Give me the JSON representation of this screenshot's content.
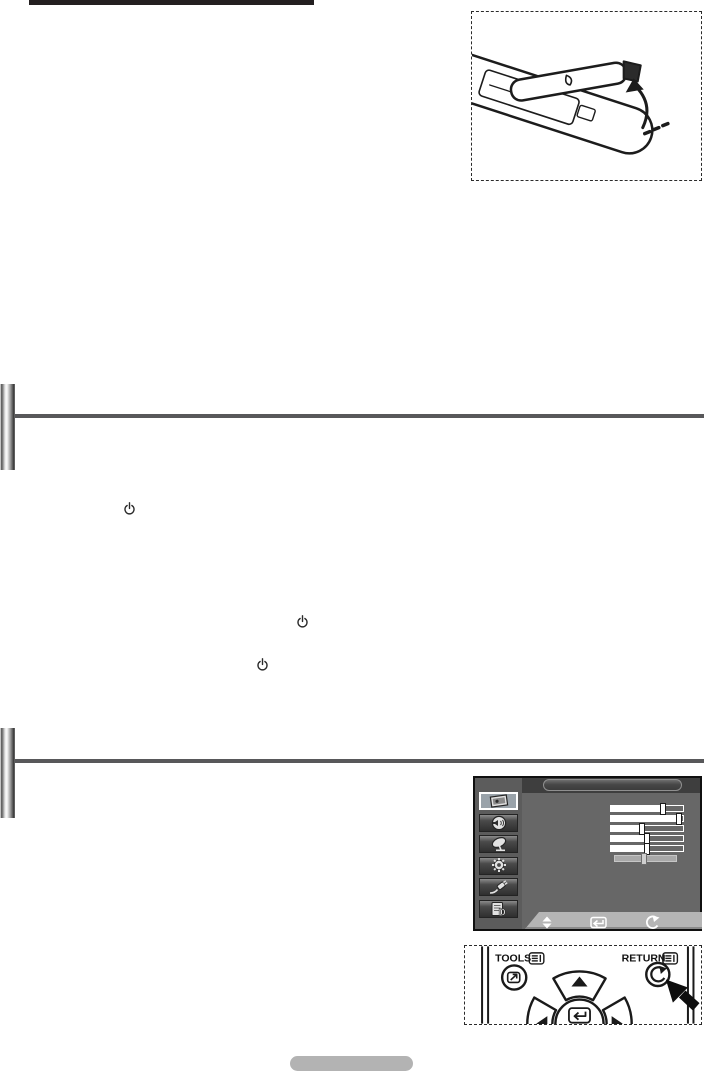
{
  "page": {
    "kind": "tv-user-manual-page",
    "title_text": "",
    "page_badge_text": ""
  },
  "figures": {
    "battery_cover": {
      "description": "remote control with battery cover being lifted, curved arrow"
    },
    "remote_nav": {
      "tools_label": "TOOLS",
      "return_label": "RETURN"
    }
  },
  "sections": [
    {
      "heading_text": "",
      "body_power_symbols": 3
    },
    {
      "heading_text": "",
      "body_power_symbols": 0
    }
  ],
  "tv_menu": {
    "title_text": "",
    "sidebar_items": [
      {
        "icon": "picture",
        "selected": true
      },
      {
        "icon": "sound",
        "selected": false
      },
      {
        "icon": "channel",
        "selected": false
      },
      {
        "icon": "setup",
        "selected": false
      },
      {
        "icon": "input",
        "selected": false
      },
      {
        "icon": "digital-menu",
        "selected": false
      }
    ],
    "sliders": [
      {
        "value": 72,
        "disabled": false
      },
      {
        "value": 95,
        "disabled": false
      },
      {
        "value": 43,
        "disabled": false
      },
      {
        "value": 50,
        "disabled": false
      },
      {
        "value": 50,
        "disabled": false
      },
      {
        "value": 47,
        "disabled": true
      }
    ],
    "footer_icons": [
      "navigate-updown-icon",
      "enter-icon",
      "return-icon"
    ]
  },
  "colors": {
    "underline": "#231f20",
    "section_line": "#58585a",
    "menu_bg": "#676767",
    "menu_header": "#3e3e3e",
    "menu_selected": "#9aa3aa",
    "menu_footer_bar": "#b5b5b5",
    "page_badge": "#b3b3b3"
  }
}
